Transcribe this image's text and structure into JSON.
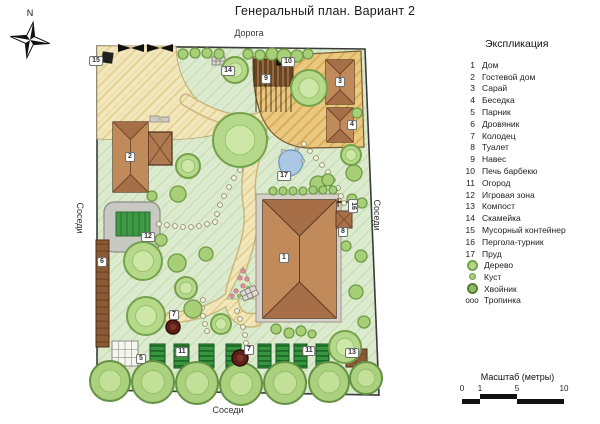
{
  "title": "Генеральный план. Вариант 2",
  "compass": {
    "north": "N"
  },
  "legend": {
    "heading": "Экспликация",
    "items": [
      {
        "num": "1",
        "label": "Дом"
      },
      {
        "num": "2",
        "label": "Гостевой дом"
      },
      {
        "num": "3",
        "label": "Сарай"
      },
      {
        "num": "4",
        "label": "Беседка"
      },
      {
        "num": "5",
        "label": "Парник"
      },
      {
        "num": "6",
        "label": "Дровяник"
      },
      {
        "num": "7",
        "label": "Колодец"
      },
      {
        "num": "8",
        "label": "Туалет"
      },
      {
        "num": "9",
        "label": "Навес"
      },
      {
        "num": "10",
        "label": "Печь барбекю"
      },
      {
        "num": "11",
        "label": "Огород"
      },
      {
        "num": "12",
        "label": "Игровая зона"
      },
      {
        "num": "13",
        "label": "Компост"
      },
      {
        "num": "14",
        "label": "Скамейка"
      },
      {
        "num": "15",
        "label": "Мусорный контейнер"
      },
      {
        "num": "16",
        "label": "Пергола-турник"
      },
      {
        "num": "17",
        "label": "Пруд"
      }
    ],
    "symbols": [
      {
        "icon": "tree-icon",
        "glyph": "",
        "label": "Дерево"
      },
      {
        "icon": "bush-icon",
        "glyph": "",
        "label": "Куст"
      },
      {
        "icon": "conifer-icon",
        "glyph": "",
        "label": "Хвойник"
      },
      {
        "icon": "path-icon",
        "glyph": "ооо",
        "label": "Тропинка"
      }
    ]
  },
  "map_labels": [
    {
      "id": "road",
      "text": "Дорога",
      "x": 249,
      "y": 33,
      "rotate": 0
    },
    {
      "id": "neighbors-left",
      "text": "Соседи",
      "x": 80,
      "y": 218,
      "rotate": 90
    },
    {
      "id": "neighbors-right",
      "text": "Соседи",
      "x": 377,
      "y": 215,
      "rotate": 90
    },
    {
      "id": "neighbors-bottom",
      "text": "Соседи",
      "x": 228,
      "y": 410,
      "rotate": 0
    }
  ],
  "markers": [
    {
      "num": "1",
      "x": 284,
      "y": 258
    },
    {
      "num": "2",
      "x": 130,
      "y": 157
    },
    {
      "num": "3",
      "x": 340,
      "y": 82
    },
    {
      "num": "4",
      "x": 352,
      "y": 125
    },
    {
      "num": "5",
      "x": 141,
      "y": 359
    },
    {
      "num": "6",
      "x": 102,
      "y": 262
    },
    {
      "num": "7",
      "x": 174,
      "y": 315
    },
    {
      "num": "7",
      "x": 249,
      "y": 350
    },
    {
      "num": "8",
      "x": 343,
      "y": 232
    },
    {
      "num": "9",
      "x": 266,
      "y": 79
    },
    {
      "num": "10",
      "x": 288,
      "y": 62
    },
    {
      "num": "11",
      "x": 182,
      "y": 352
    },
    {
      "num": "11",
      "x": 309,
      "y": 351
    },
    {
      "num": "12",
      "x": 148,
      "y": 237
    },
    {
      "num": "13",
      "x": 352,
      "y": 353
    },
    {
      "num": "14",
      "x": 228,
      "y": 71
    },
    {
      "num": "15",
      "x": 96,
      "y": 61
    },
    {
      "num": "16",
      "x": 353,
      "y": 206,
      "rotate": 90
    },
    {
      "num": "17",
      "x": 284,
      "y": 176
    }
  ],
  "scale": {
    "title": "Масштаб (метры)",
    "ticks": [
      "0",
      "1",
      "5",
      "10"
    ]
  },
  "colors": {
    "lawn": "#ddebd0",
    "path_sand": "#f2e7bd",
    "deck": "#eac87f",
    "roof": "#b07a50",
    "tree": "#b6d88b",
    "pond": "#a8c8e6",
    "plot_green": "#37953f"
  }
}
